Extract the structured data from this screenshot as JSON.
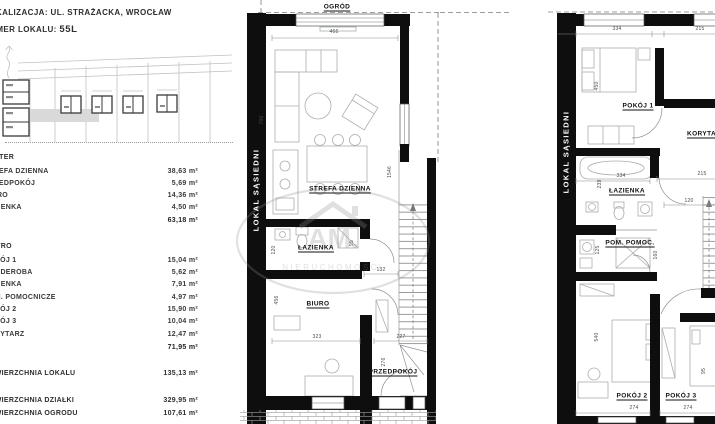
{
  "header": {
    "location_line": "LOKALIZACJA: UL. STRAŻACKA, WROCŁAW",
    "unit_label": "NUMER LOKALU:",
    "unit_value": "55L"
  },
  "areas": {
    "floor1_title": "PARTER",
    "floor1_rows": [
      {
        "label": "STREFA DZIENNA",
        "value": "38,63 m²"
      },
      {
        "label": "PRZEDPOKÓJ",
        "value": "5,69 m²"
      },
      {
        "label": "BIURO",
        "value": "14,36 m²"
      },
      {
        "label": "ŁAZIENKA",
        "value": "4,50 m²"
      }
    ],
    "floor1_total": "63,18 m²",
    "floor2_title": "PIĘTRO",
    "floor2_rows": [
      {
        "label": "POKÓJ 1",
        "value": "15,04 m²"
      },
      {
        "label": "GARDEROBA",
        "value": "5,62 m²"
      },
      {
        "label": "ŁAZIENKA",
        "value": "7,91 m²"
      },
      {
        "label": "POM. POMOCNICZE",
        "value": "4,97 m²"
      },
      {
        "label": "POKÓJ 2",
        "value": "15,90 m²"
      },
      {
        "label": "POKÓJ 3",
        "value": "10,04 m²"
      },
      {
        "label": "KORYTARZ",
        "value": "12,47 m²"
      }
    ],
    "floor2_total": "71,95 m²",
    "summary": [
      {
        "label": "POWIERZCHNIA LOKALU",
        "value": "135,13 m²"
      },
      {
        "label": "POWIERZCHNIA DZIAŁKI",
        "value": "329,95 m²"
      },
      {
        "label": "POWIERZCHNIA OGRODU",
        "value": "107,61 m²"
      }
    ]
  },
  "plan_ground": {
    "garden_label": "OGRÓD",
    "neighbor_label": "LOKAL SĄSIEDNI",
    "room_strefa": "STREFA DZIENNA",
    "room_lazienka": "ŁAZIENKA",
    "room_biuro": "BIURO",
    "room_przedpokoj": "PRZEDPOKÓJ",
    "dims": {
      "top": "466",
      "left": "700",
      "stair": "1546",
      "d120": "120",
      "d95": "95",
      "d132": "132",
      "d456": "456",
      "d323": "323",
      "d227": "227",
      "d276": "276"
    }
  },
  "plan_upper": {
    "neighbor_label": "LOKAL SĄSIEDNI",
    "room_pokoj1": "POKÓJ 1",
    "room_korytarz": "KORYTARZ",
    "room_lazienka": "ŁAZIENKA",
    "room_pom": "POM. POMOC.",
    "room_pokoj2": "POKÓJ 2",
    "room_pokoj3": "POKÓJ 3",
    "dims": {
      "d334a": "334",
      "d215a": "215",
      "d450": "450",
      "d334b": "334",
      "d215b": "215",
      "d120": "120",
      "d239": "239",
      "d125": "125",
      "d160": "160",
      "d540": "540",
      "d274a": "274",
      "d274b": "274",
      "d95": "95"
    }
  },
  "watermark": {
    "monogram": "AM.",
    "name": "NIERUCHOMOŚCI"
  }
}
